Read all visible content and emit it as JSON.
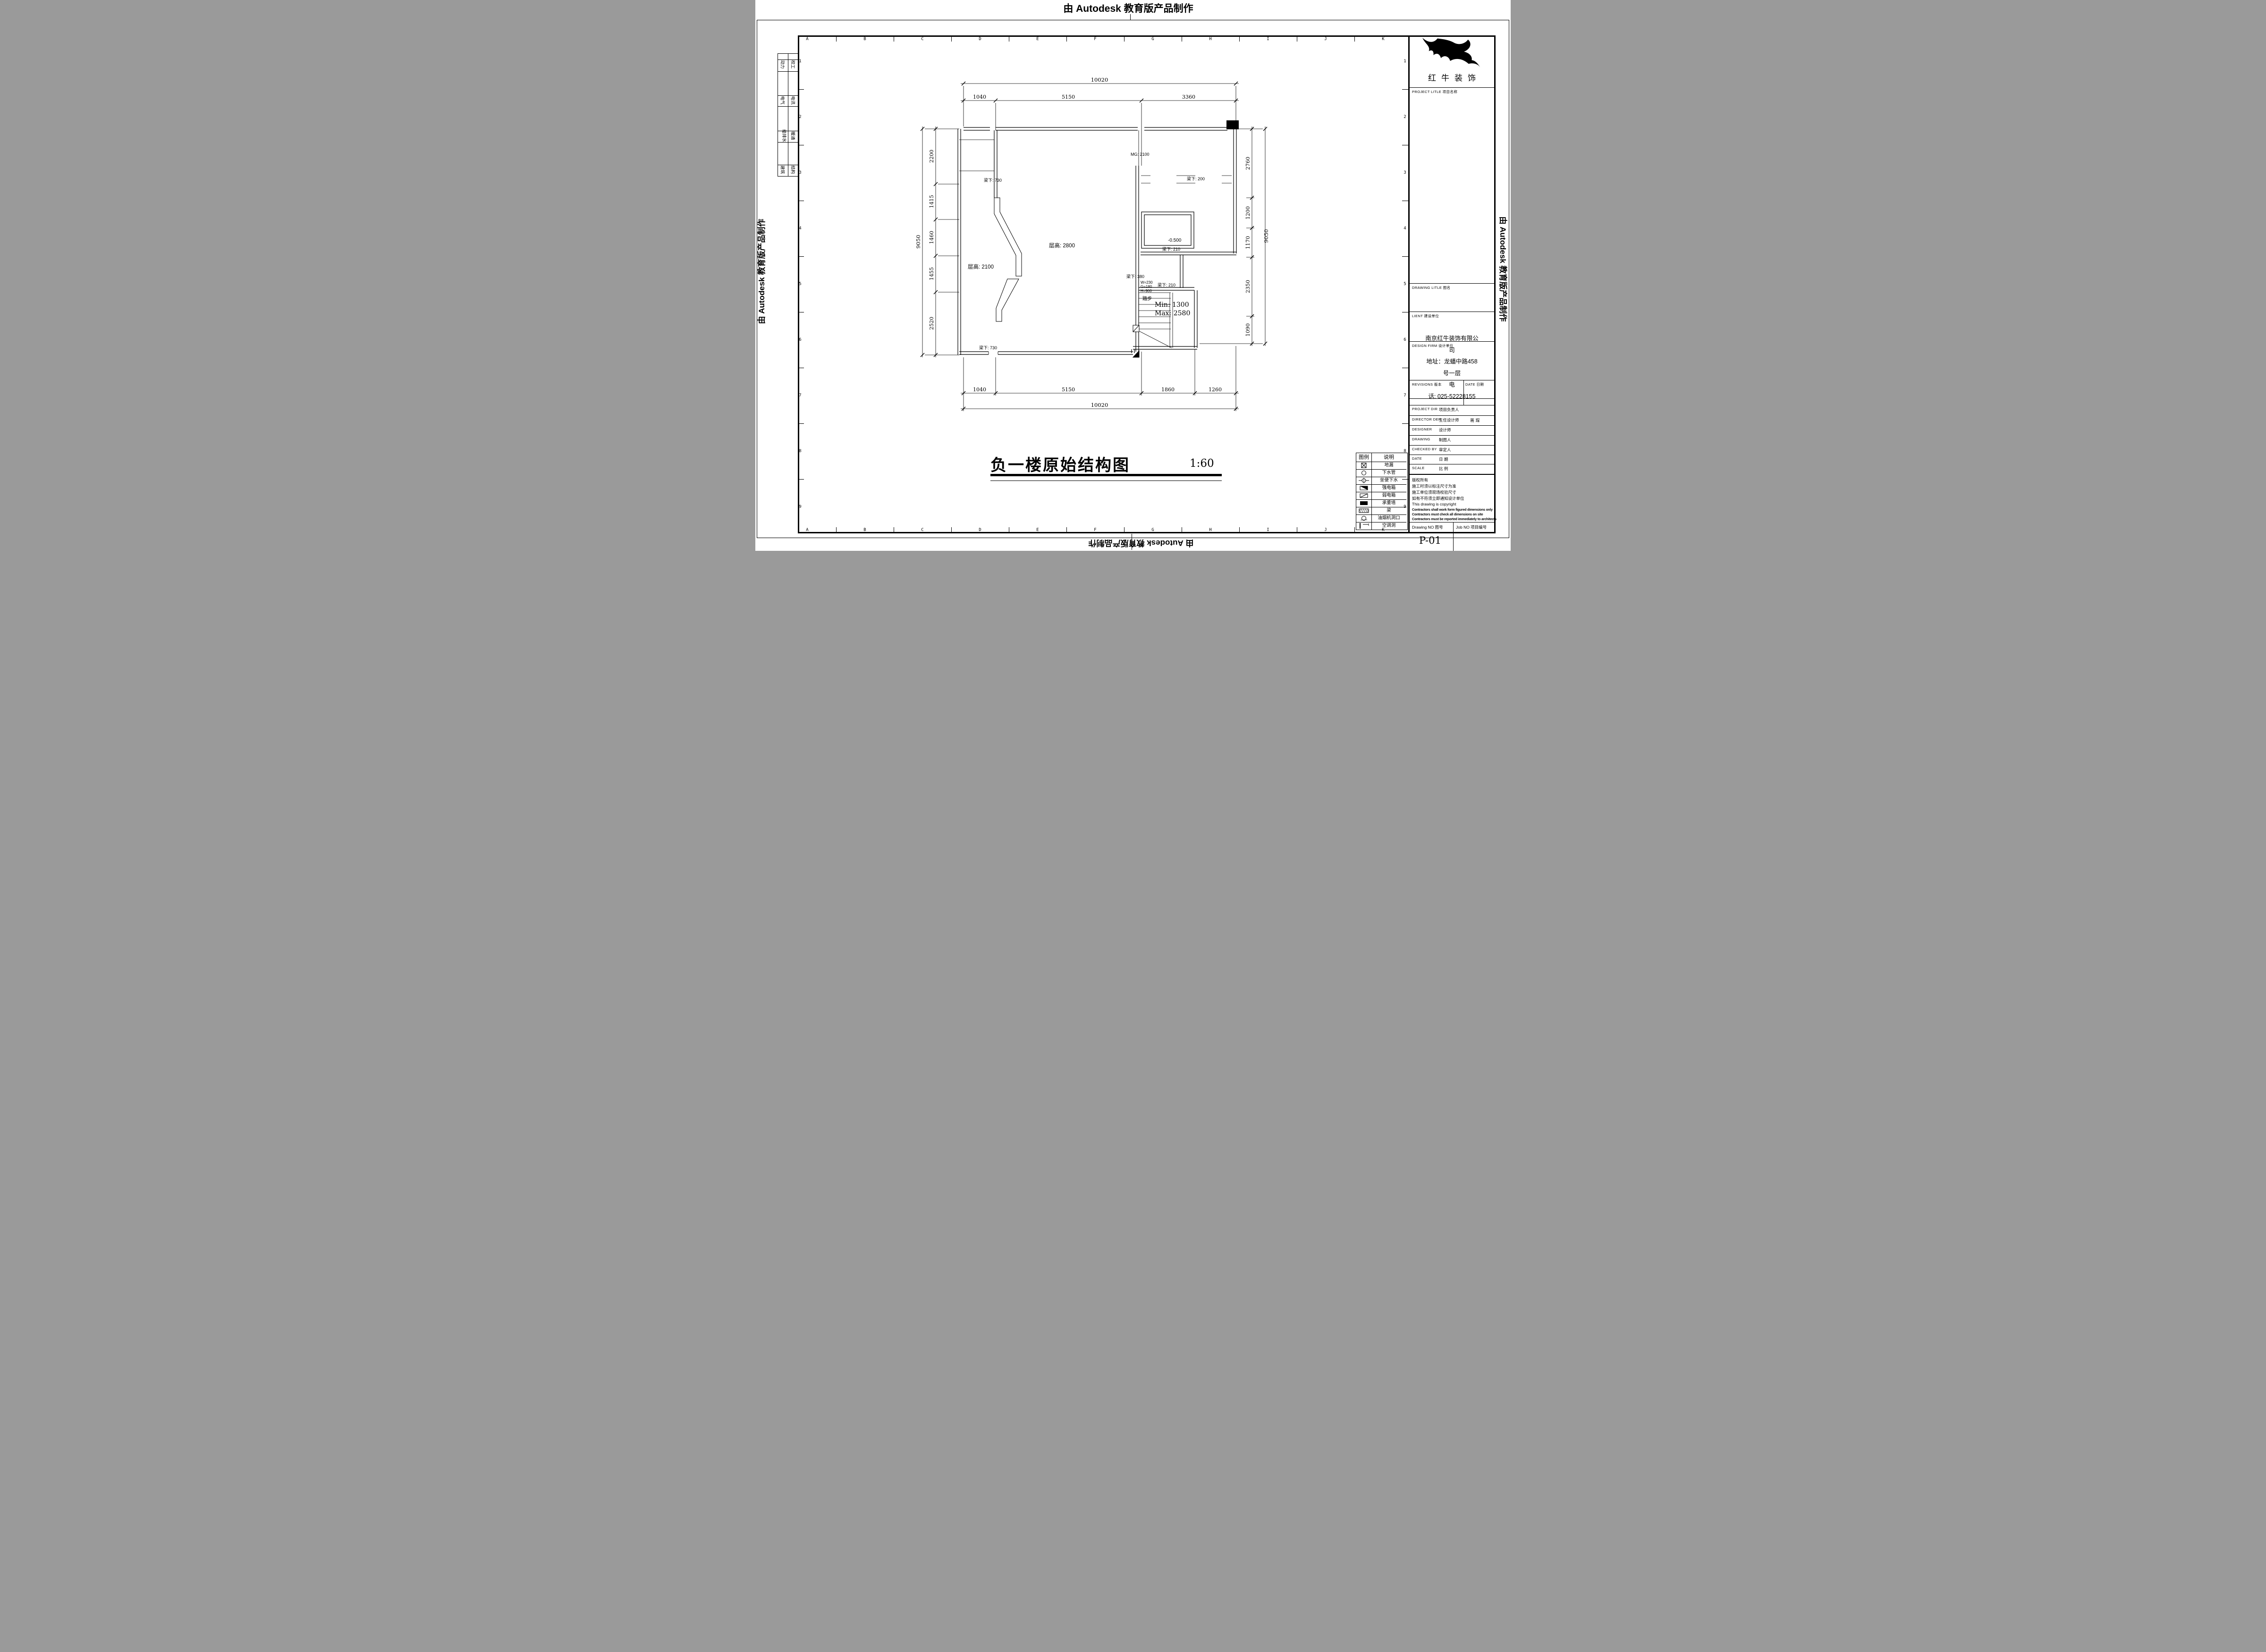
{
  "banner": {
    "top": "由 Autodesk 教育版产品制作",
    "left": "由 Autodesk 教育版产品制作",
    "right": "由 Autodesk 教育版产品制作",
    "bottom": "由 Autodesk 教育版产品制作"
  },
  "grid": {
    "letters": [
      "A",
      "B",
      "C",
      "D",
      "E",
      "F",
      "G",
      "H",
      "I",
      "J",
      "K"
    ],
    "numbers": [
      "1",
      "2",
      "3",
      "4",
      "5",
      "6",
      "7",
      "8",
      "9"
    ]
  },
  "disciplines": {
    "rows": [
      {
        "left": "动力",
        "right": "校工"
      },
      {
        "left": "电气",
        "right": "电讯"
      },
      {
        "left": "给排水",
        "right": "暖通"
      },
      {
        "left": "建筑",
        "right": "结构"
      }
    ]
  },
  "plan": {
    "title": "负一楼原始结构图",
    "scale_text": "1:60",
    "labels": {
      "mg": "MG: 2100",
      "beam_730_top": "梁下: 730",
      "beam_730_bottom": "梁下: 730",
      "beam_200": "梁下: 200",
      "beam_210_a": "梁下: 210",
      "beam_210_b": "梁下: 210",
      "beam_380": "梁下: 380",
      "height_2800": "层高: 2800",
      "height_2100": "层高: 2100",
      "level": "-0.500",
      "stair_w": "W=230",
      "stair_g": "G=180",
      "stair_h": "H=900",
      "steps": "踏步",
      "stair_min": "Min: 1300",
      "stair_max": "Max: 2580"
    },
    "dims": {
      "top_overall": "10020",
      "top": [
        "1040",
        "5150",
        "3360"
      ],
      "bottom": [
        "1040",
        "5150",
        "1860",
        "1260"
      ],
      "bottom_overall": "10020",
      "left": [
        "2200",
        "1415",
        "1460",
        "1455",
        "2520"
      ],
      "left_overall": "9050",
      "right": [
        "2760",
        "1200",
        "1170",
        "2350",
        "1090"
      ],
      "right_overall": "9050"
    }
  },
  "legend": {
    "header_symbol": "图例",
    "header_desc": "说明",
    "rows": [
      {
        "symbol": "floor-drain",
        "desc": "地漏"
      },
      {
        "symbol": "drain-pipe",
        "desc": "下水管"
      },
      {
        "symbol": "toilet-drain",
        "desc": "坐便下水"
      },
      {
        "symbol": "strong-power-box",
        "desc": "强电箱"
      },
      {
        "symbol": "weak-power-box",
        "desc": "弱电箱"
      },
      {
        "symbol": "load-bearing-wall",
        "desc": "承重墙"
      },
      {
        "symbol": "beam",
        "desc": "梁"
      },
      {
        "symbol": "hood-opening",
        "desc": "油烟机洞口"
      },
      {
        "symbol": "ac-hole",
        "desc": "空调洞"
      }
    ]
  },
  "titleblock": {
    "company": "红牛装饰",
    "project_label": "PROJECT LITLE  项目名称",
    "drawing_label": "DRAWING LITLE  图名",
    "client_label": "LIENT  建设单位",
    "firm_label": "DESIGN FIRM 设计单位",
    "revisions_label": "REVISIONS 版本",
    "date_small_label": "DATE 日期",
    "firm_info": [
      "南京红牛装饰有限公",
      "司",
      "地址：龙蟠中路458",
      "号一层",
      "电",
      "话: 025-52228155"
    ],
    "rows": [
      {
        "en": "PROJECT DIR",
        "zh": "项目负责人",
        "value": ""
      },
      {
        "en": "DIRECTOR DER",
        "zh": "主任设计师",
        "value": "蒋  琛"
      },
      {
        "en": "DESIGNER",
        "zh": "设计师",
        "value": ""
      },
      {
        "en": "DRAWING",
        "zh": "制图人",
        "value": ""
      },
      {
        "en": "CHECKED BY",
        "zh": "审定人",
        "value": ""
      },
      {
        "en": "DATE",
        "zh": "日  期",
        "value": ""
      },
      {
        "en": "SCALE",
        "zh": "比  例",
        "value": ""
      }
    ],
    "copyright": [
      "版权所有",
      "施工时须以标注尺寸为准",
      "施工单位须现场校验尺寸",
      "如有不符须立即通知设计单位",
      "This drawing is copyright",
      "Contractors shall work form figured dimensions only",
      "Contractors must check all dimensions on site",
      "Contractors must be reported immediately to architects"
    ],
    "drawing_no_label": "Drawing NO  图号",
    "drawing_no": "P-01",
    "job_no_label": "Job NO  项目编号"
  }
}
